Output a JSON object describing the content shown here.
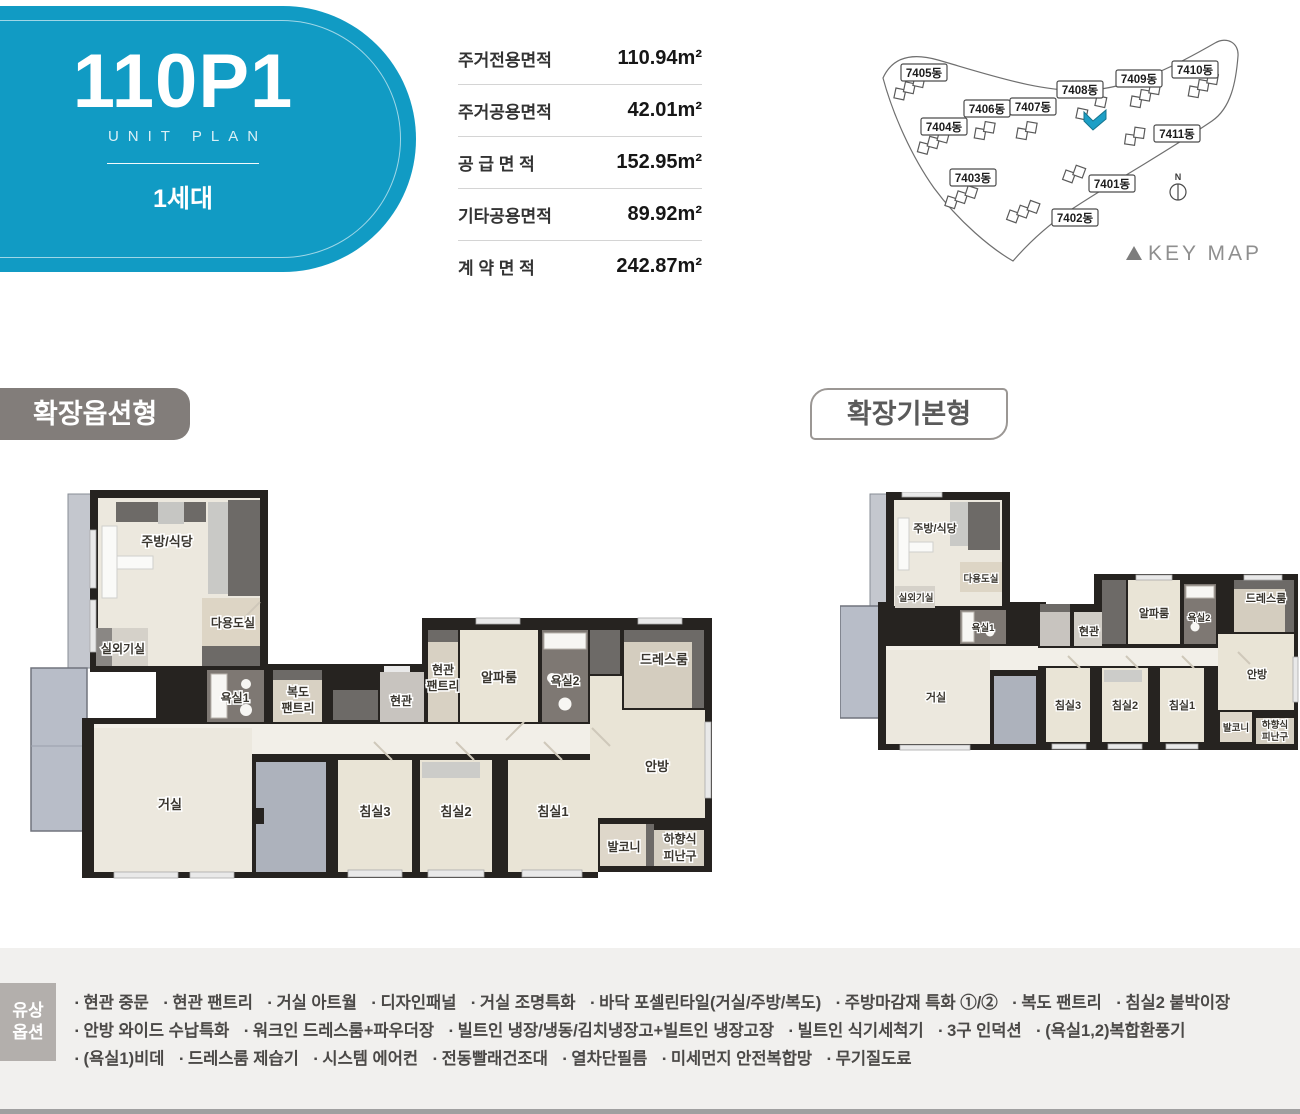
{
  "unit": {
    "code": "110P1",
    "subtitle": "UNIT PLAN",
    "household": "1세대"
  },
  "area_table": {
    "rows": [
      {
        "label": "주거전용면적",
        "value": "110.94m²"
      },
      {
        "label": "주거공용면적",
        "value": "42.01m²"
      },
      {
        "label": "공 급 면 적",
        "value": "152.95m²"
      },
      {
        "label": "기타공용면적",
        "value": "89.92m²"
      },
      {
        "label": "계 약 면 적",
        "value": "242.87m²"
      }
    ]
  },
  "key_map": {
    "caption": "KEY MAP",
    "north": "N",
    "buildings": [
      "7405동",
      "7406동",
      "7407동",
      "7408동",
      "7409동",
      "7410동",
      "7404동",
      "7411동",
      "7403동",
      "7401동",
      "7402동"
    ],
    "highlight_color": "#1d9fc6"
  },
  "plan_tabs": {
    "option_type": "확장옵션형",
    "basic_type": "확장기본형"
  },
  "rooms": {
    "kitchen": "주방/식당",
    "utility": "다용도실",
    "outdoor_unit": "실외기실",
    "bath1": "욕실1",
    "hall_pantry_line1": "복도",
    "hall_pantry_line2": "팬트리",
    "entry": "현관",
    "entry_pantry_line1": "현관",
    "entry_pantry_line2": "팬트리",
    "alpha": "알파룸",
    "bath2": "욕실2",
    "dress": "드레스룸",
    "living": "거실",
    "bed3": "침실3",
    "bed2": "침실2",
    "bed1": "침실1",
    "master": "안방",
    "balcony": "발코니",
    "escape_line1": "하향식",
    "escape_line2": "피난구"
  },
  "paid_options": {
    "label_line1": "유상",
    "label_line2": "옵션",
    "lines": [
      [
        "현관 중문",
        "현관 팬트리",
        "거실 아트월",
        "디자인패널",
        "거실 조명특화",
        "바닥 포셀린타일(거실/주방/복도)",
        "주방마감재 특화 ①/②",
        "복도 팬트리",
        "침실2 붙박이장"
      ],
      [
        "안방 와이드 수납특화",
        "워크인 드레스룸+파우더장",
        "빌트인 냉장/냉동/김치냉장고+빌트인 냉장고장",
        "빌트인 식기세척기",
        "3구 인덕션",
        "(욕실1,2)복합환풍기"
      ],
      [
        "(욕실1)비데",
        "드레스룸 제습기",
        "시스템 에어컨",
        "전동빨래건조대",
        "열차단필름",
        "미세먼지 안전복합망",
        "무기질도료"
      ]
    ]
  },
  "colors": {
    "accent_blue": "#119bc4",
    "badge_gray": "#827d7a",
    "strip_bg": "#f1f0ee"
  }
}
